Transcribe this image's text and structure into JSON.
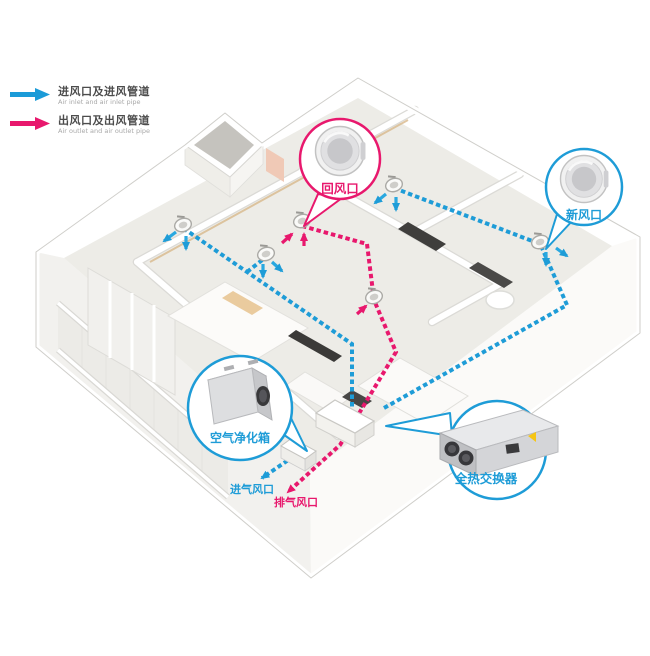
{
  "legend": {
    "items": [
      {
        "id": "air-inlet",
        "label_zh": "进风口及进风管道",
        "label_en": "Air inlet and air inlet pipe",
        "color": "#1b9bd8"
      },
      {
        "id": "air-outlet",
        "label_zh": "出风口及出风管道",
        "label_en": "Air outlet and air outlet pipe",
        "color": "#e8186d"
      }
    ]
  },
  "callouts": {
    "return_air": {
      "label": "回风口",
      "color": "#e8186d"
    },
    "fresh_air": {
      "label": "新风口",
      "color": "#1e9cd7"
    },
    "air_purifier": {
      "label": "空气净化箱",
      "color": "#1e9cd7"
    },
    "heat_exchanger": {
      "label": "全热交换器",
      "color": "#1e9cd7"
    }
  },
  "wall_vents": {
    "intake": {
      "label": "进气风口",
      "color": "#1e9cd7"
    },
    "exhaust": {
      "label": "排气风口",
      "color": "#e8186d"
    }
  },
  "colors": {
    "supply_pipe": "#1e9cd7",
    "exhaust_pipe": "#e8186d",
    "wall": "#ffffff",
    "floor": "#edece7",
    "dark_furniture": "#3c3b39"
  }
}
